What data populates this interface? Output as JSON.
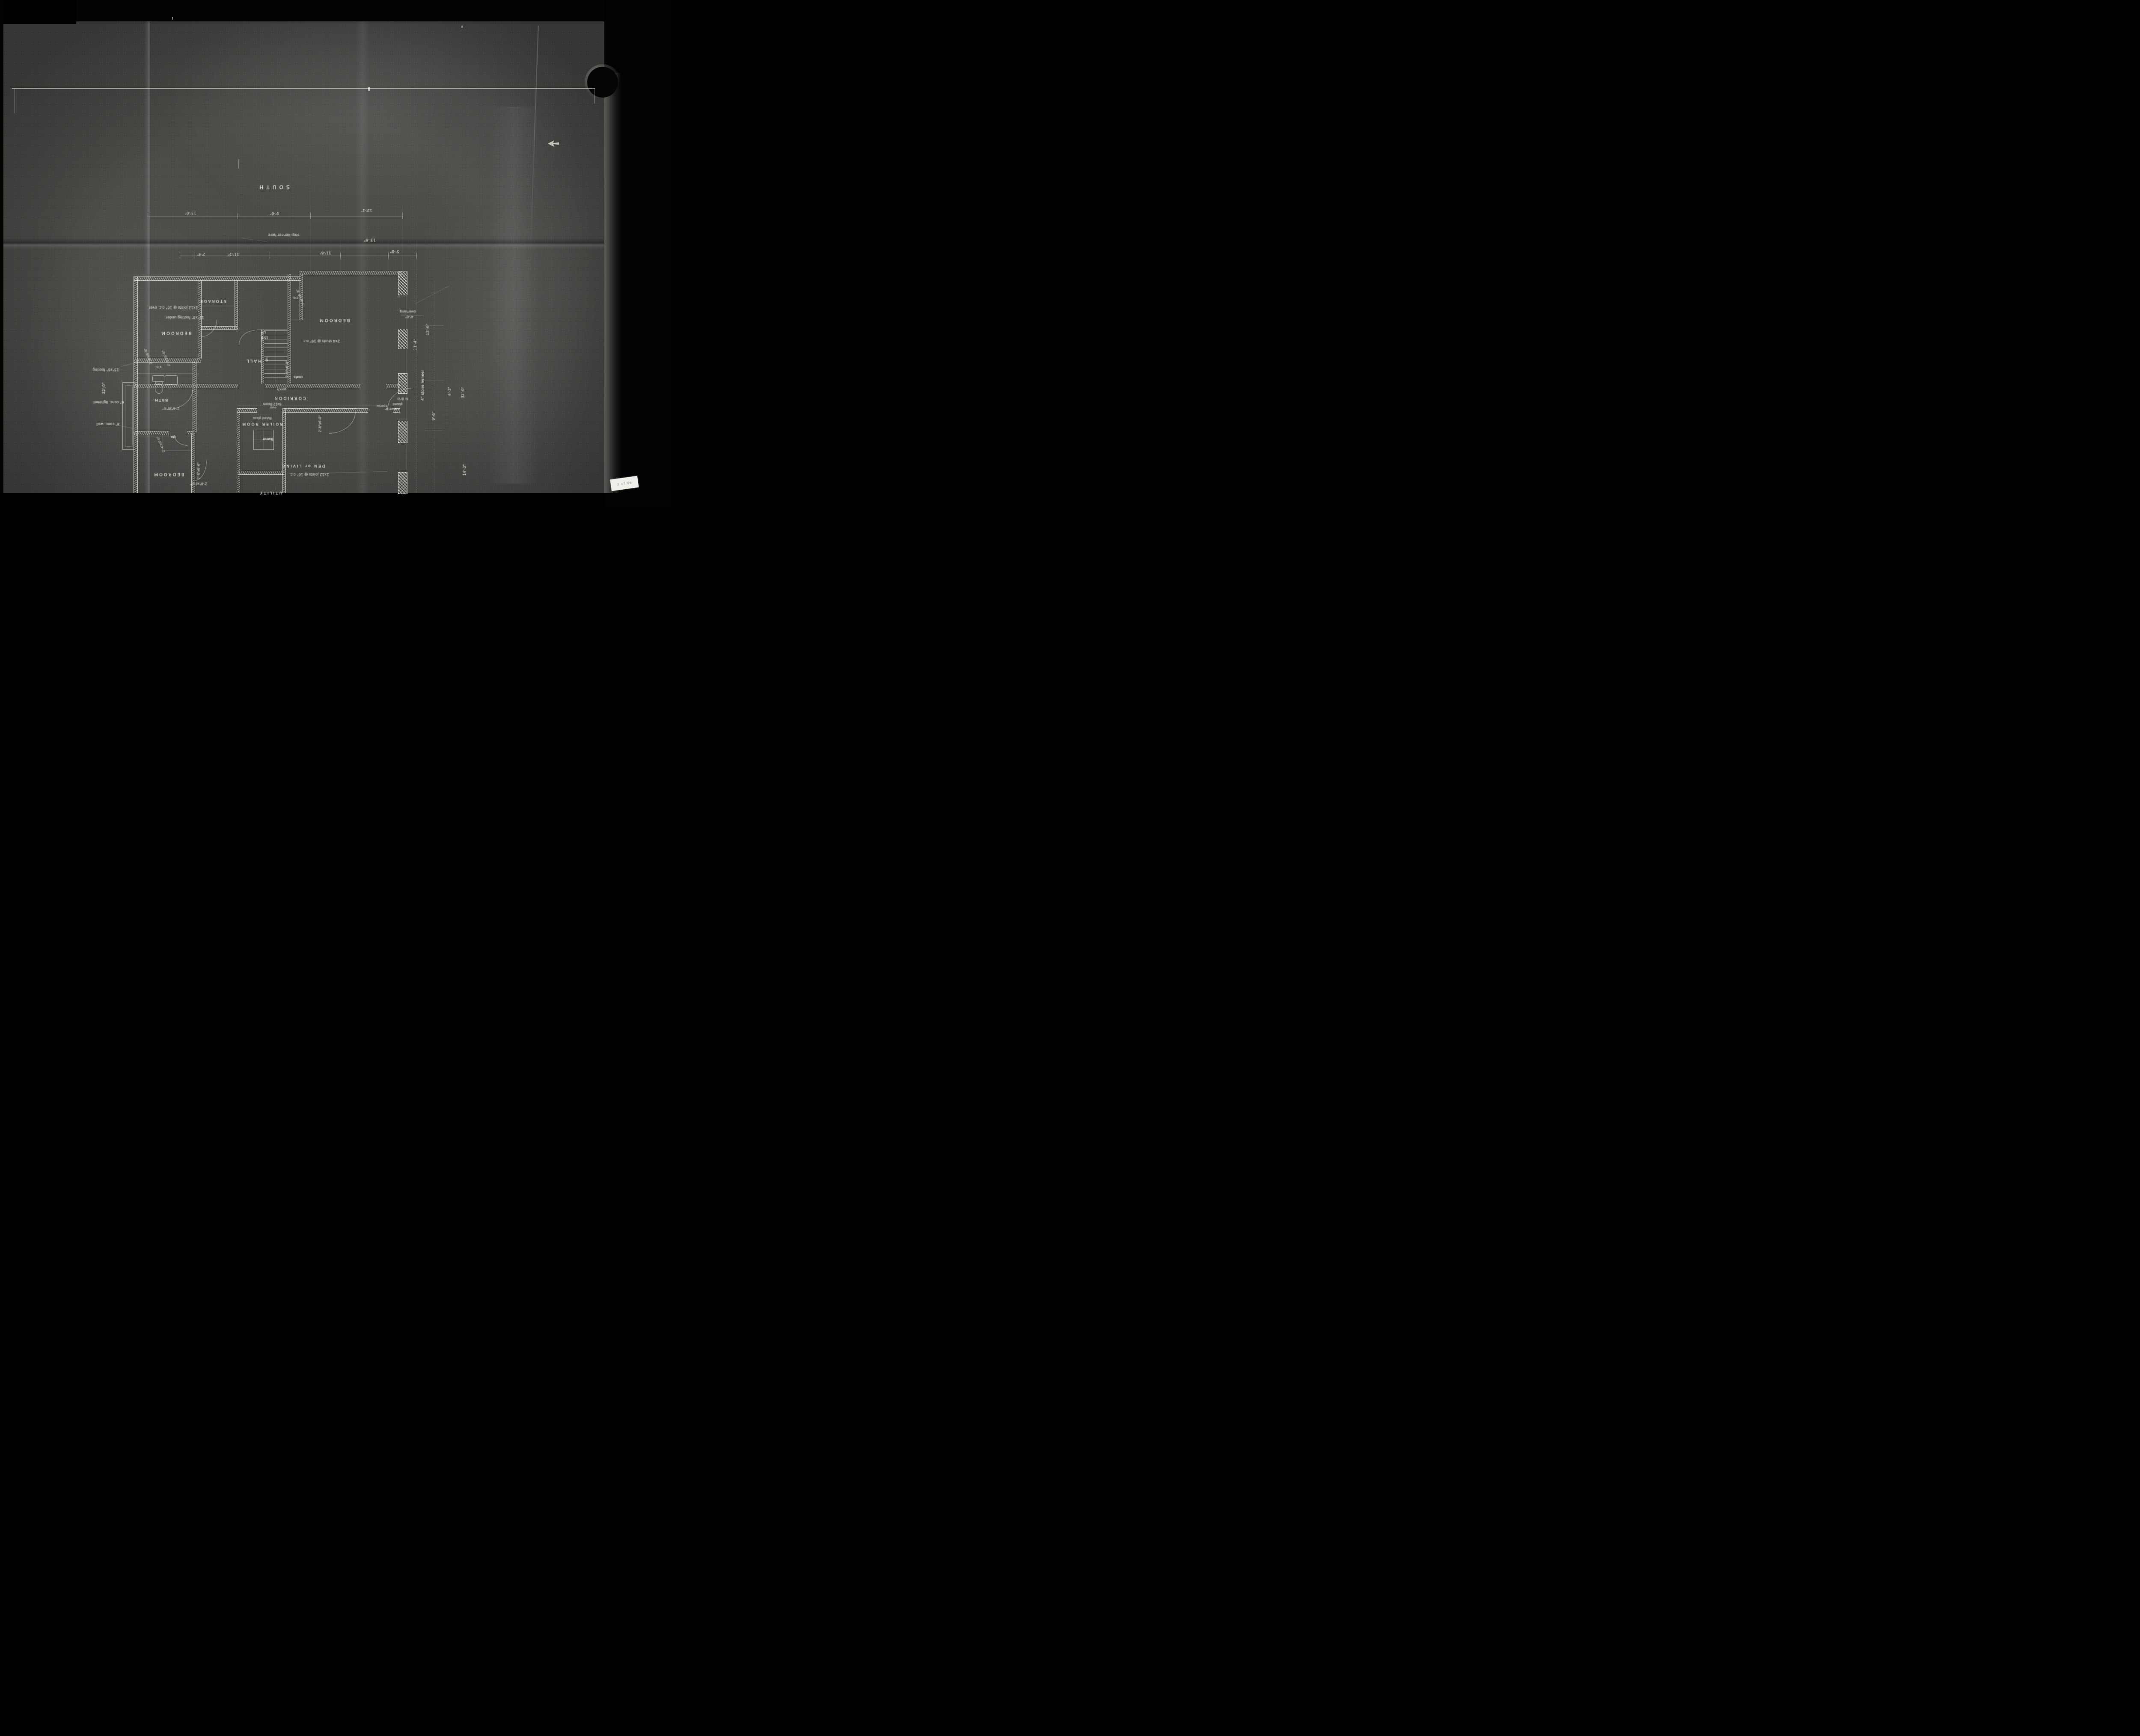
{
  "photo": {
    "sticker_text": "2 of de"
  },
  "plan": {
    "compass_south": "SOUTH",
    "rooms": {
      "bedroom_nw": "BEDROOM",
      "storage": "STORAGE",
      "clo_top": "clo.",
      "bedroom_e": "BEDROOM",
      "hall": "HALL",
      "coats": "coats",
      "corridor": "CORRIDOR",
      "clo_bath": "clo.",
      "bath": "BATH.",
      "clo_sw": "clo.",
      "bedroom_sw": "BEDROOM",
      "boiler": "BOILER ROOM",
      "utility": "UTILITY",
      "den": "DEN or LIVING"
    },
    "stair": {
      "up": "UP",
      "risers": "15 R",
      "down": "dn"
    },
    "notes": {
      "joists_nw": "2x12 joists @ 16\" o.c. over",
      "footing_under": "12\"x8\" footing under",
      "studs_e": "2x4 studs @ 16\" o.c.",
      "beam": "6x12 Beam",
      "beam_over": "over",
      "fluted_glass": "fluted glass",
      "burner": "Burner",
      "joists_se": "2x12 joists @ 16\" o.c.",
      "veneer_stop": "stop Veneer here",
      "stone_veneer": "4\" stone Veneer",
      "overhang": "overhang",
      "footing_left": "15\"x6\" footing",
      "lightwell": "6\" conc. lightwell",
      "conc_wall": "8\" conc. wall",
      "porch": "porch",
      "special_1": "special",
      "special_2": "glazed",
      "special_3": "fir th'ld"
    },
    "dims": {
      "top1_a": "13'-0\"",
      "top1_b": "9'-6\"",
      "top1_c": "13'-2\"",
      "top1_d": "13'-6\"",
      "top2_a": "2'-4\"",
      "top2_b": "11'-2\"",
      "top2_c": "11'-6\"",
      "top2_d": "5'-8\"",
      "right_overhang": "4'-0\"",
      "right_a": "13'-6\"",
      "right_b": "11'-4\"",
      "right_c": "4'-3\"",
      "right_d": "32'-0\"",
      "right_e": "9'-6\"",
      "right_f": "14'-3\"",
      "left_a": "32'-0\""
    },
    "doors": {
      "storage_door": "2'-6\"x6'-8\"",
      "hall_door": "2'-8\"x6'-8\"",
      "bedroom_e_door": "2'-8\"x6'-8\"",
      "special_door": "2'-8\"x6'-8\"",
      "den_door_v": "2'-8\"x6'-6\"",
      "den_door_h": "2'-8\"x6'-6\"",
      "bath_door": "2'-6\"x6'-6\"",
      "window_a": "2'-4\"x6'-6\"",
      "window_b": "2'-4\"x6'-6\"",
      "window_sw": "2'-4\"x6'-6\""
    }
  }
}
